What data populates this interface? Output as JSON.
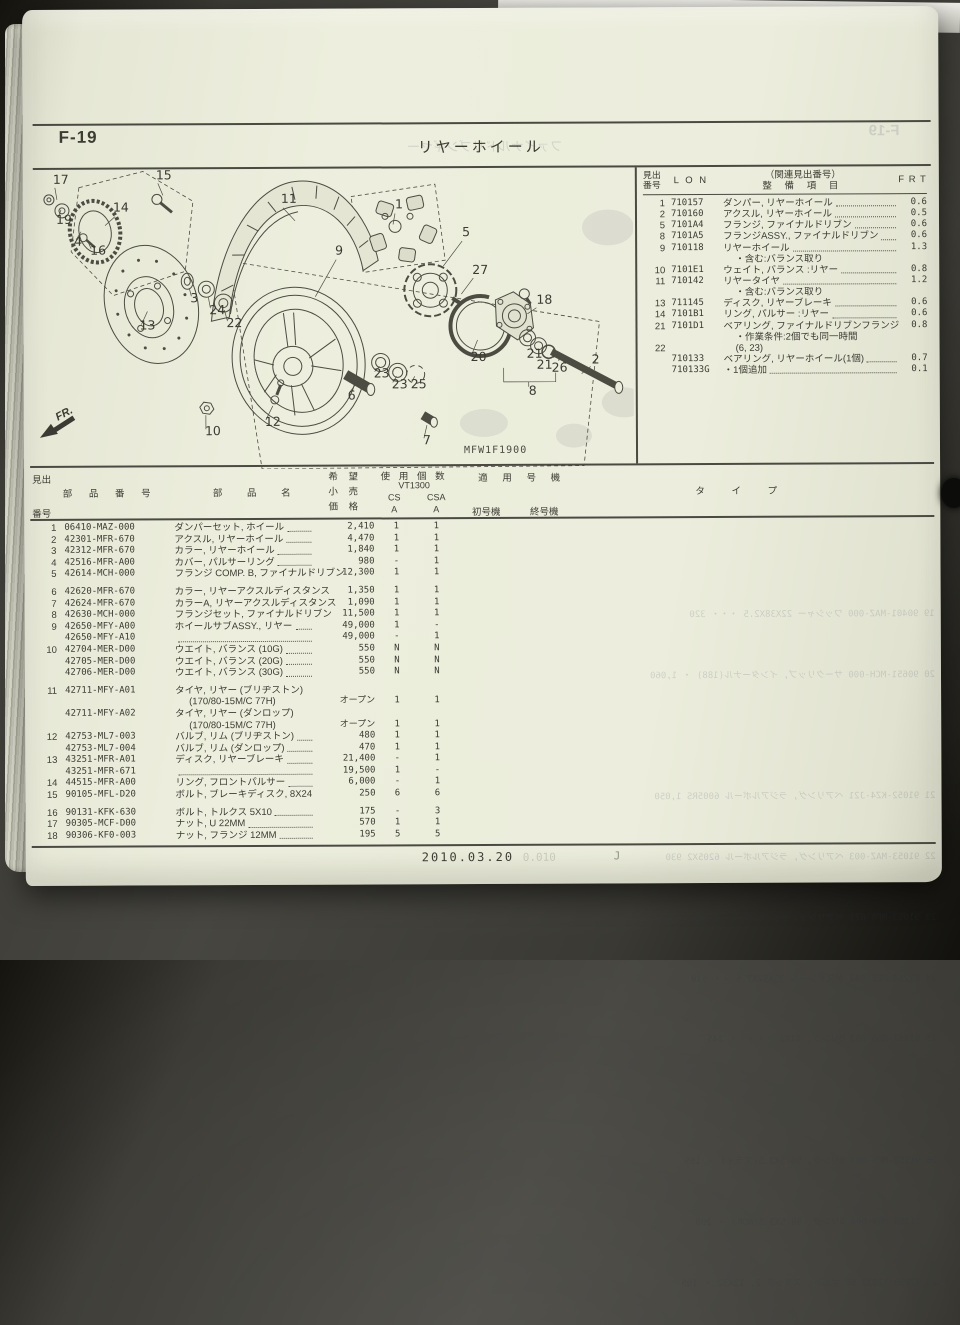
{
  "colors": {
    "page_bg": "#eceddc",
    "ink": "#3c3c33",
    "backdrop": "#3a3933"
  },
  "header": {
    "page_code": "F-19",
    "title": "リヤーホイール"
  },
  "service_table": {
    "header": {
      "no1": "見出",
      "no2": "番号",
      "lon": "L O N",
      "rel": "（関連見出番号）",
      "item": "整 備 項 目",
      "frt": "F R T"
    },
    "rows": [
      {
        "no": "1",
        "lon": "710157",
        "item": "ダンパー, リヤーホイール",
        "frt": "0.6"
      },
      {
        "no": "2",
        "lon": "710160",
        "item": "アクスル, リヤーホイール",
        "frt": "0.5"
      },
      {
        "no": "5",
        "lon": "7101A4",
        "item": "フランジ, ファイナルドリブン",
        "frt": "0.6"
      },
      {
        "no": "8",
        "lon": "7101A5",
        "item": "フランジASSY., ファイナルドリブン",
        "frt": "0.6"
      },
      {
        "no": "9",
        "lon": "710118",
        "item": "リヤーホイール",
        "frt": "1.3"
      },
      {
        "item": "・含む:バランス取り",
        "flags": [
          "sub"
        ]
      },
      {
        "no": "10",
        "lon": "7101E1",
        "item": "ウェイト, バランス :リヤー",
        "frt": "0.8"
      },
      {
        "no": "11",
        "lon": "710142",
        "item": "リヤータイヤ",
        "frt": "1.2"
      },
      {
        "item": "・含む:バランス取り",
        "flags": [
          "sub"
        ]
      },
      {
        "no": "13",
        "lon": "711145",
        "item": "ディスク, リヤーブレーキ",
        "frt": "0.6"
      },
      {
        "no": "14",
        "lon": "7101B1",
        "item": "リング, パルサー :リヤー",
        "frt": "0.6"
      },
      {
        "no": "21",
        "lon": "7101D1",
        "item": "ベアリング, ファイナルドリブンフランジ",
        "frt": "0.8"
      },
      {
        "item": "・作業条件:2個でも同一時間",
        "flags": [
          "sub"
        ]
      },
      {
        "no": "22",
        "item": "(6, 23)",
        "flags": [
          "sub"
        ]
      },
      {
        "lon": "710133",
        "item": "ベアリング, リヤーホイール(1個)",
        "frt": "0.7"
      },
      {
        "lon": "710133G",
        "item": "・1個追加",
        "frt": "0.1"
      }
    ]
  },
  "parts_table": {
    "header": {
      "no1": "見出",
      "no2": "番号",
      "part": "部 品 番 号",
      "name": "部 品 名",
      "price1": "希 望",
      "price2": "小 売",
      "price3": "価 格",
      "qty1": "使 用 個 数",
      "qty2": "VT1300",
      "qty_cs": "CS",
      "qty_csa": "CSA",
      "qty_a1": "A",
      "qty_a2": "A",
      "apply": "適 用 号 機",
      "first": "初号機",
      "last": "終号機",
      "type": "タ イ プ"
    },
    "rows": [
      {
        "no": "1",
        "part": "06410-MAZ-000",
        "name": "ダンパーセット, ホイール",
        "price": "2,410",
        "cs": "1",
        "csa": "1"
      },
      {
        "no": "2",
        "part": "42301-MFR-670",
        "name": "アクスル, リヤーホイール",
        "price": "4,470",
        "cs": "1",
        "csa": "1"
      },
      {
        "no": "3",
        "part": "42312-MFR-670",
        "name": "カラー, リヤーホイール",
        "price": "1,840",
        "cs": "1",
        "csa": "1"
      },
      {
        "no": "4",
        "part": "42516-MFR-A00",
        "name": "カバー, パルサーリング",
        "price": "980",
        "cs": "-",
        "csa": "1"
      },
      {
        "no": "5",
        "part": "42614-MCH-000",
        "name": "フランジ COMP. B, ファイナルドリブン",
        "price": "12,300",
        "cs": "1",
        "csa": "1",
        "flags": [
          "noleader"
        ]
      },
      {
        "no": "6",
        "part": "42620-MFR-670",
        "name": "カラー, リヤーアクスルディスタンス",
        "price": "1,350",
        "cs": "1",
        "csa": "1",
        "flags": [
          "gap"
        ]
      },
      {
        "no": "7",
        "part": "42624-MFR-670",
        "name": "カラーA, リヤーアクスルディスタンス",
        "price": "1,090",
        "cs": "1",
        "csa": "1"
      },
      {
        "no": "8",
        "part": "42630-MCH-000",
        "name": "フランジセット, ファイナルドリブン",
        "price": "11,500",
        "cs": "1",
        "csa": "1"
      },
      {
        "no": "9",
        "part": "42650-MFY-A00",
        "name": "ホイールサブASSY., リヤー",
        "price": "49,000",
        "cs": "1",
        "csa": "-"
      },
      {
        "part": "42650-MFY-A10",
        "name": "",
        "price": "49,000",
        "cs": "-",
        "csa": "1"
      },
      {
        "no": "10",
        "part": "42704-MER-D00",
        "name": "ウエイト, バランス (10G)",
        "price": "550",
        "cs": "N",
        "csa": "N"
      },
      {
        "part": "42705-MER-D00",
        "name": "ウエイト, バランス (20G)",
        "price": "550",
        "cs": "N",
        "csa": "N"
      },
      {
        "part": "42706-MER-D00",
        "name": "ウエイト, バランス (30G)",
        "price": "550",
        "cs": "N",
        "csa": "N"
      },
      {
        "no": "11",
        "part": "42711-MFY-A01",
        "name": "タイヤ, リヤー (ブリヂストン)",
        "flags": [
          "gap",
          "noleader"
        ]
      },
      {
        "name": "(170/80-15M/C 77H)",
        "price": "オープン",
        "cs": "1",
        "csa": "1",
        "flags": [
          "indent",
          "noleader"
        ]
      },
      {
        "part": "42711-MFY-A02",
        "name": "タイヤ, リヤー (ダンロップ)",
        "flags": [
          "noleader"
        ]
      },
      {
        "name": "(170/80-15M/C 77H)",
        "price": "オープン",
        "cs": "1",
        "csa": "1",
        "flags": [
          "indent",
          "noleader"
        ]
      },
      {
        "no": "12",
        "part": "42753-ML7-003",
        "name": "バルブ, リム (ブリヂストン)",
        "price": "480",
        "cs": "1",
        "csa": "1"
      },
      {
        "part": "42753-ML7-004",
        "name": "バルブ, リム (ダンロップ)",
        "price": "470",
        "cs": "1",
        "csa": "1"
      },
      {
        "no": "13",
        "part": "43251-MFR-A01",
        "name": "ディスク, リヤーブレーキ",
        "price": "21,400",
        "cs": "-",
        "csa": "1"
      },
      {
        "part": "43251-MFR-671",
        "name": "",
        "price": "19,500",
        "cs": "1",
        "csa": "-"
      },
      {
        "no": "14",
        "part": "44515-MFR-A00",
        "name": "リング, フロントパルサー",
        "price": "6,000",
        "cs": "-",
        "csa": "1"
      },
      {
        "no": "15",
        "part": "90105-MFL-D20",
        "name": "ボルト, ブレーキディスク, 8X24",
        "price": "250",
        "cs": "6",
        "csa": "6"
      },
      {
        "no": "16",
        "part": "90131-KFK-630",
        "name": "ボルト, トルクス 5X10",
        "price": "175",
        "cs": "-",
        "csa": "3",
        "flags": [
          "gap"
        ]
      },
      {
        "no": "17",
        "part": "90305-MCF-D00",
        "name": "ナット, U 22MM",
        "price": "570",
        "cs": "1",
        "csa": "1"
      },
      {
        "no": "18",
        "part": "90306-KF0-003",
        "name": "ナット, フランジ 12MM",
        "price": "195",
        "cs": "5",
        "csa": "5"
      }
    ]
  },
  "diagram": {
    "code": "MFW1F1900",
    "fr": "FR.",
    "callouts": [
      {
        "n": "17",
        "x": 20,
        "y": 14
      },
      {
        "n": "15",
        "x": 123,
        "y": 10
      },
      {
        "n": "19",
        "x": 23,
        "y": 54
      },
      {
        "n": "4",
        "x": 41,
        "y": 76
      },
      {
        "n": "16",
        "x": 57,
        "y": 85
      },
      {
        "n": "14",
        "x": 80,
        "y": 42
      },
      {
        "n": "11",
        "x": 248,
        "y": 34
      },
      {
        "n": "1",
        "x": 362,
        "y": 40
      },
      {
        "n": "9",
        "x": 302,
        "y": 86
      },
      {
        "n": "5",
        "x": 429,
        "y": 68
      },
      {
        "n": "27",
        "x": 439,
        "y": 106
      },
      {
        "n": "18",
        "x": 503,
        "y": 136
      },
      {
        "n": "3",
        "x": 157,
        "y": 133
      },
      {
        "n": "24",
        "x": 176,
        "y": 145
      },
      {
        "n": "22",
        "x": 193,
        "y": 158
      },
      {
        "n": "13",
        "x": 106,
        "y": 160
      },
      {
        "n": "10",
        "x": 171,
        "y": 266
      },
      {
        "n": "12",
        "x": 231,
        "y": 257
      },
      {
        "n": "6",
        "x": 314,
        "y": 231
      },
      {
        "n": "23",
        "x": 340,
        "y": 209
      },
      {
        "n": "23",
        "x": 358,
        "y": 220
      },
      {
        "n": "25",
        "x": 377,
        "y": 220
      },
      {
        "n": "7",
        "x": 389,
        "y": 276
      },
      {
        "n": "20",
        "x": 437,
        "y": 193
      },
      {
        "n": "21",
        "x": 493,
        "y": 190
      },
      {
        "n": "21",
        "x": 503,
        "y": 201
      },
      {
        "n": "26",
        "x": 518,
        "y": 204
      },
      {
        "n": "8",
        "x": 495,
        "y": 227
      },
      {
        "n": "2",
        "x": 558,
        "y": 196
      }
    ]
  },
  "footer": {
    "date": "2010.03.20"
  },
  "bleedthrough": {
    "title_ghost": "ファイナルドリブンギヤー",
    "page_code_ghost": "F-19",
    "footer_ghost1": "0.010",
    "footer_ghost2": "J",
    "parts_lines": [
      {
        "t": "19 90401-MAZ-000 ワッシャー 22X38X2.5 ・・・ 320"
      },
      {
        "t": "20 90651-MCH-000 サークリップ, インターナル(188) ・ 1,060"
      },
      {
        "t": ""
      },
      {
        "t": "21 91052-KZ4-J21 ベアリング, ラジアルボール 6005RS 1,050"
      },
      {
        "t": "22 91053-MAZ-003 ベアリング, ラジアルボール 6205X2 930"
      },
      {
        "t": "23 91053-MFR-671 ベアリング, ラジアルボール 60/28 1,160"
      },
      {
        "t": "24 91254-MEE-003 ダストシール 35X52X7.5 ・・ 510"
      },
      {
        "t": "25 91302-MA6-003 Oリング, 61X2 ・・・・・ 245"
      },
      {
        "t": ""
      },
      {
        "t": "26 91358-MB9-003 Oリング, 50.5X3.5(アライ) ・ 165"
      },
      {
        "t": "   91358-MB9-004 Oリング, 50.5X3.5(NOK) ・ 200"
      },
      {
        "t": "27 92900-12032-0E ボルト, スタッド 2, 12X32 ・ 105"
      }
    ]
  }
}
